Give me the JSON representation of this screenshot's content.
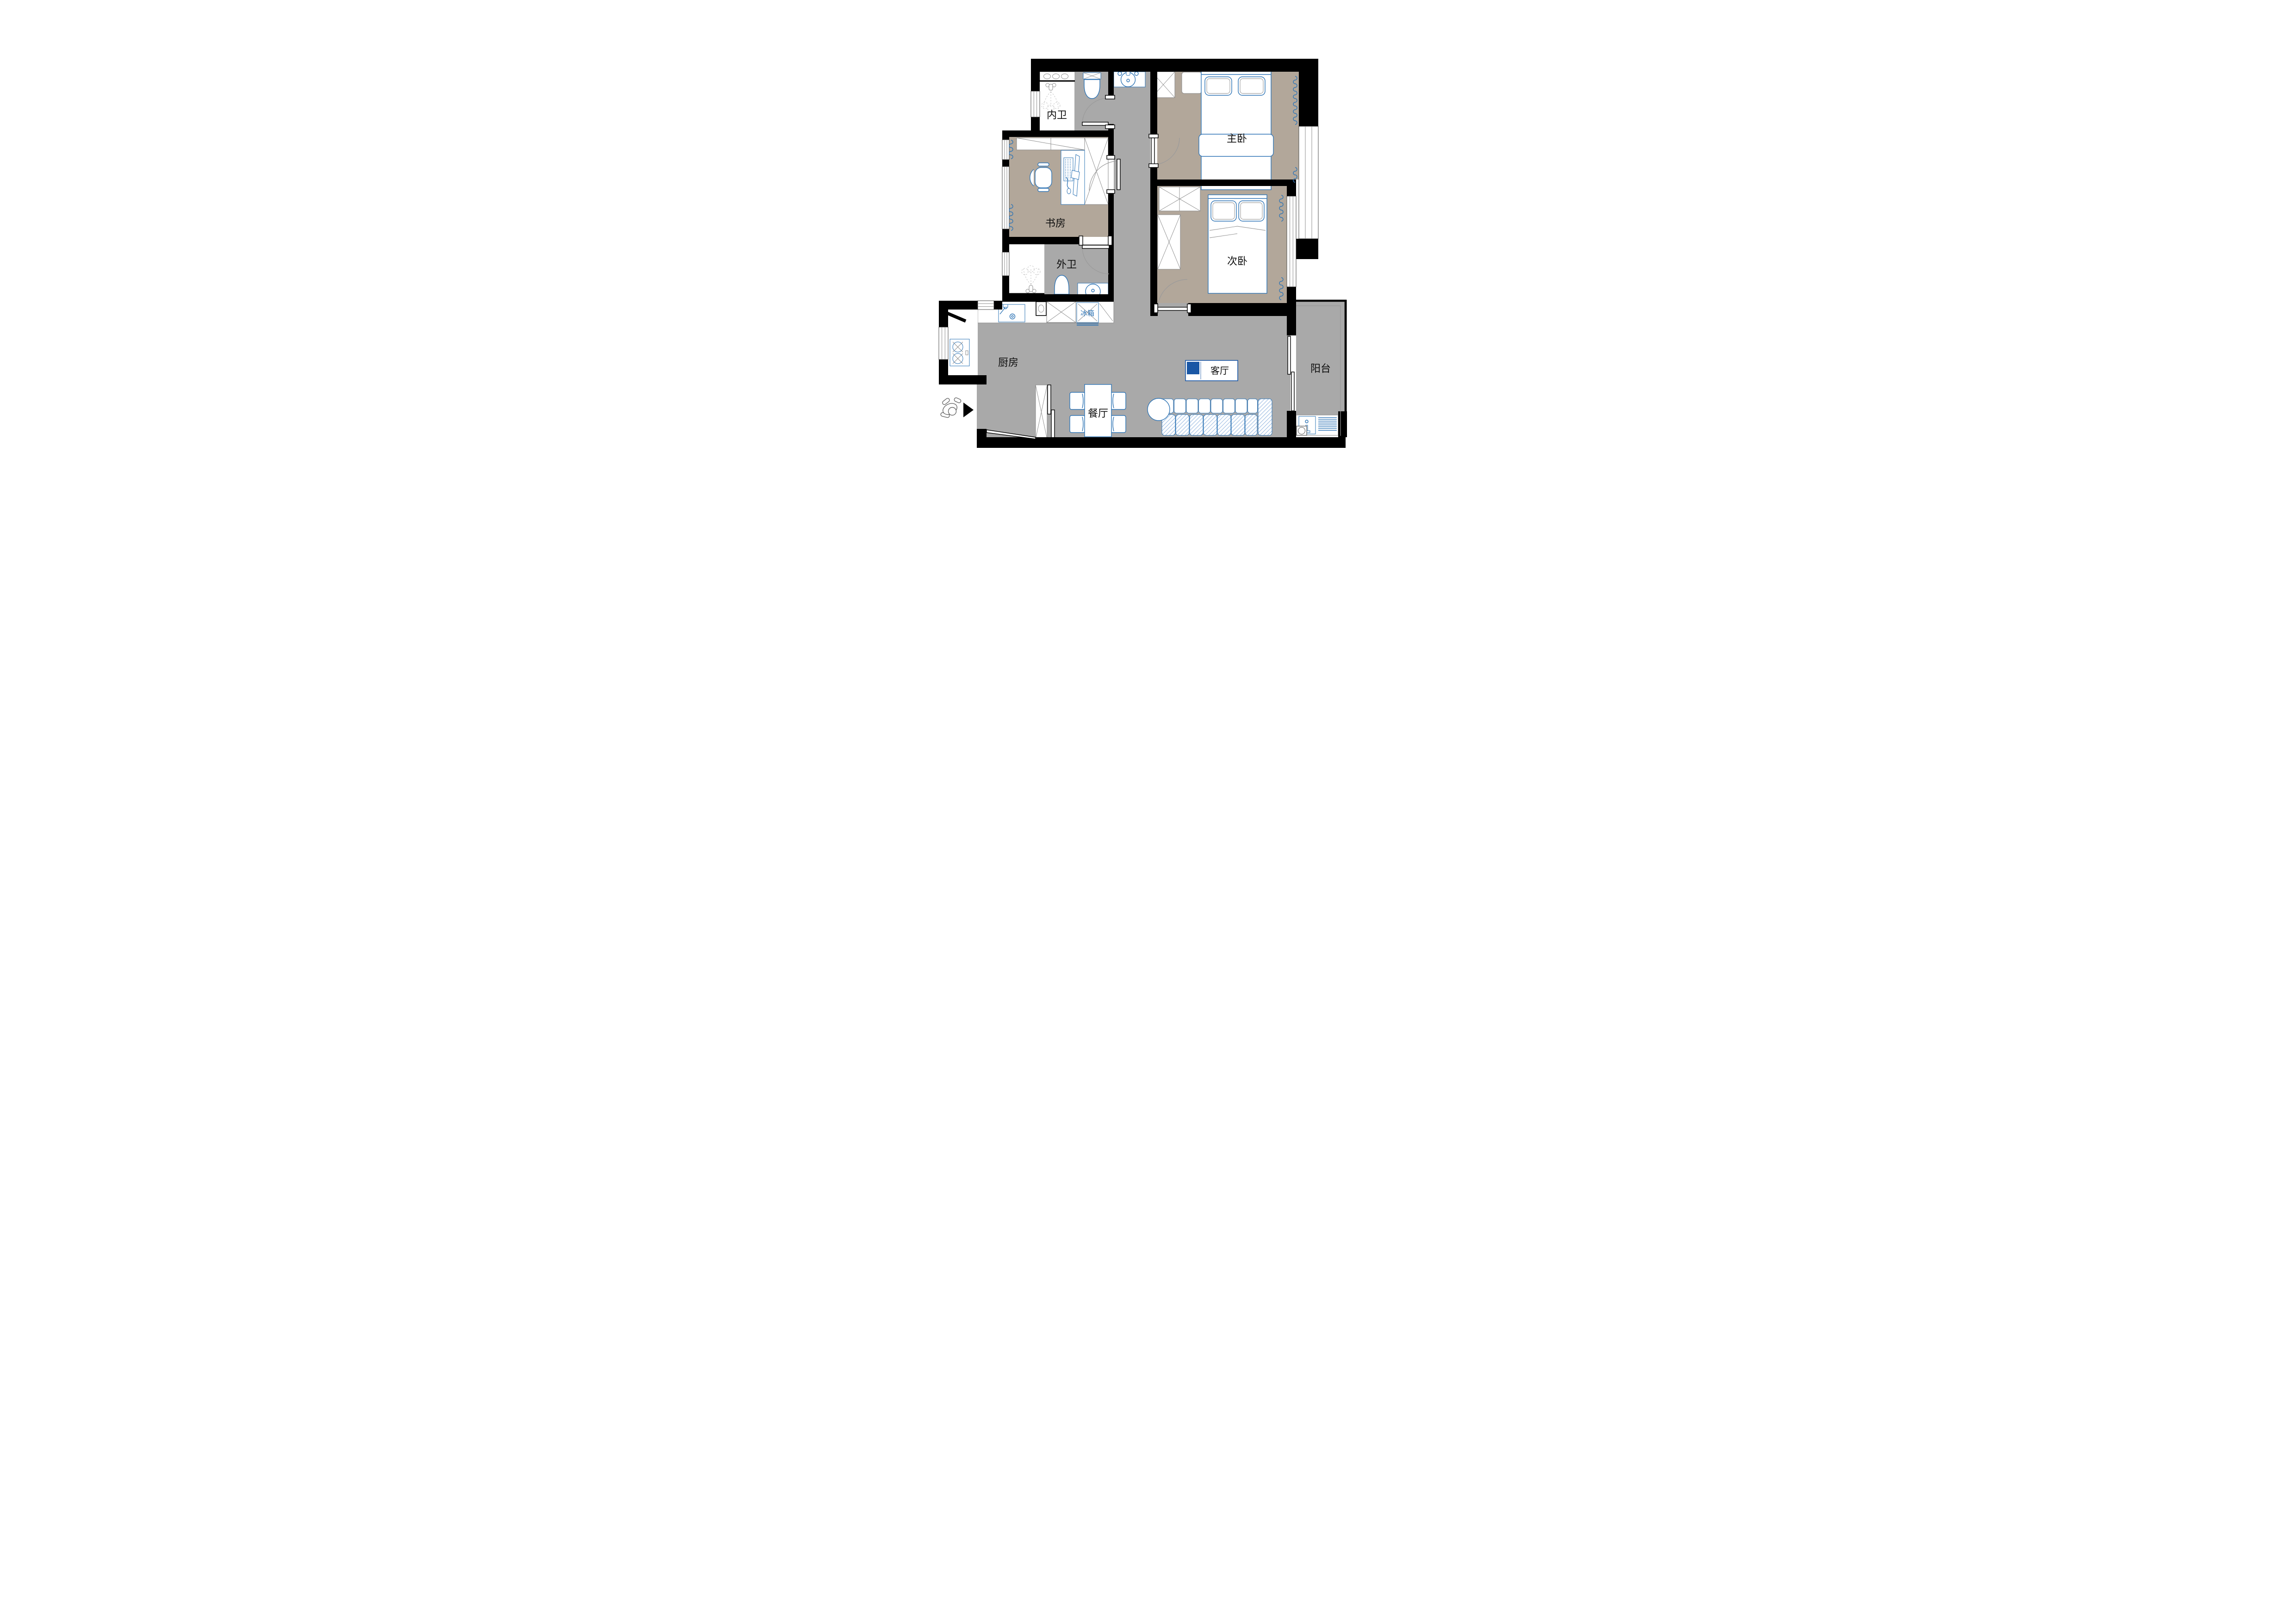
{
  "plan": {
    "type": "apartment-floor-plan",
    "rooms": [
      {
        "id": "inner-bathroom",
        "label": "内卫"
      },
      {
        "id": "study",
        "label": "书房"
      },
      {
        "id": "outer-bathroom",
        "label": "外卫"
      },
      {
        "id": "master-bedroom",
        "label": "主卧"
      },
      {
        "id": "second-bedroom",
        "label": "次卧"
      },
      {
        "id": "kitchen",
        "label": "厨房"
      },
      {
        "id": "dining-room",
        "label": "餐厅"
      },
      {
        "id": "living-room",
        "label": "客厅"
      },
      {
        "id": "balcony",
        "label": "阳台"
      }
    ],
    "appliances": [
      {
        "id": "fridge",
        "label": "冰箱"
      }
    ],
    "colors": {
      "wall": "#000000",
      "floor_public": "#a9a9a9",
      "floor_bedroom": "#b2a79a",
      "furniture_line": "#2e74b5",
      "hatch_blue": "#7da7d9",
      "living_label_accent": "#1a57a5"
    }
  }
}
